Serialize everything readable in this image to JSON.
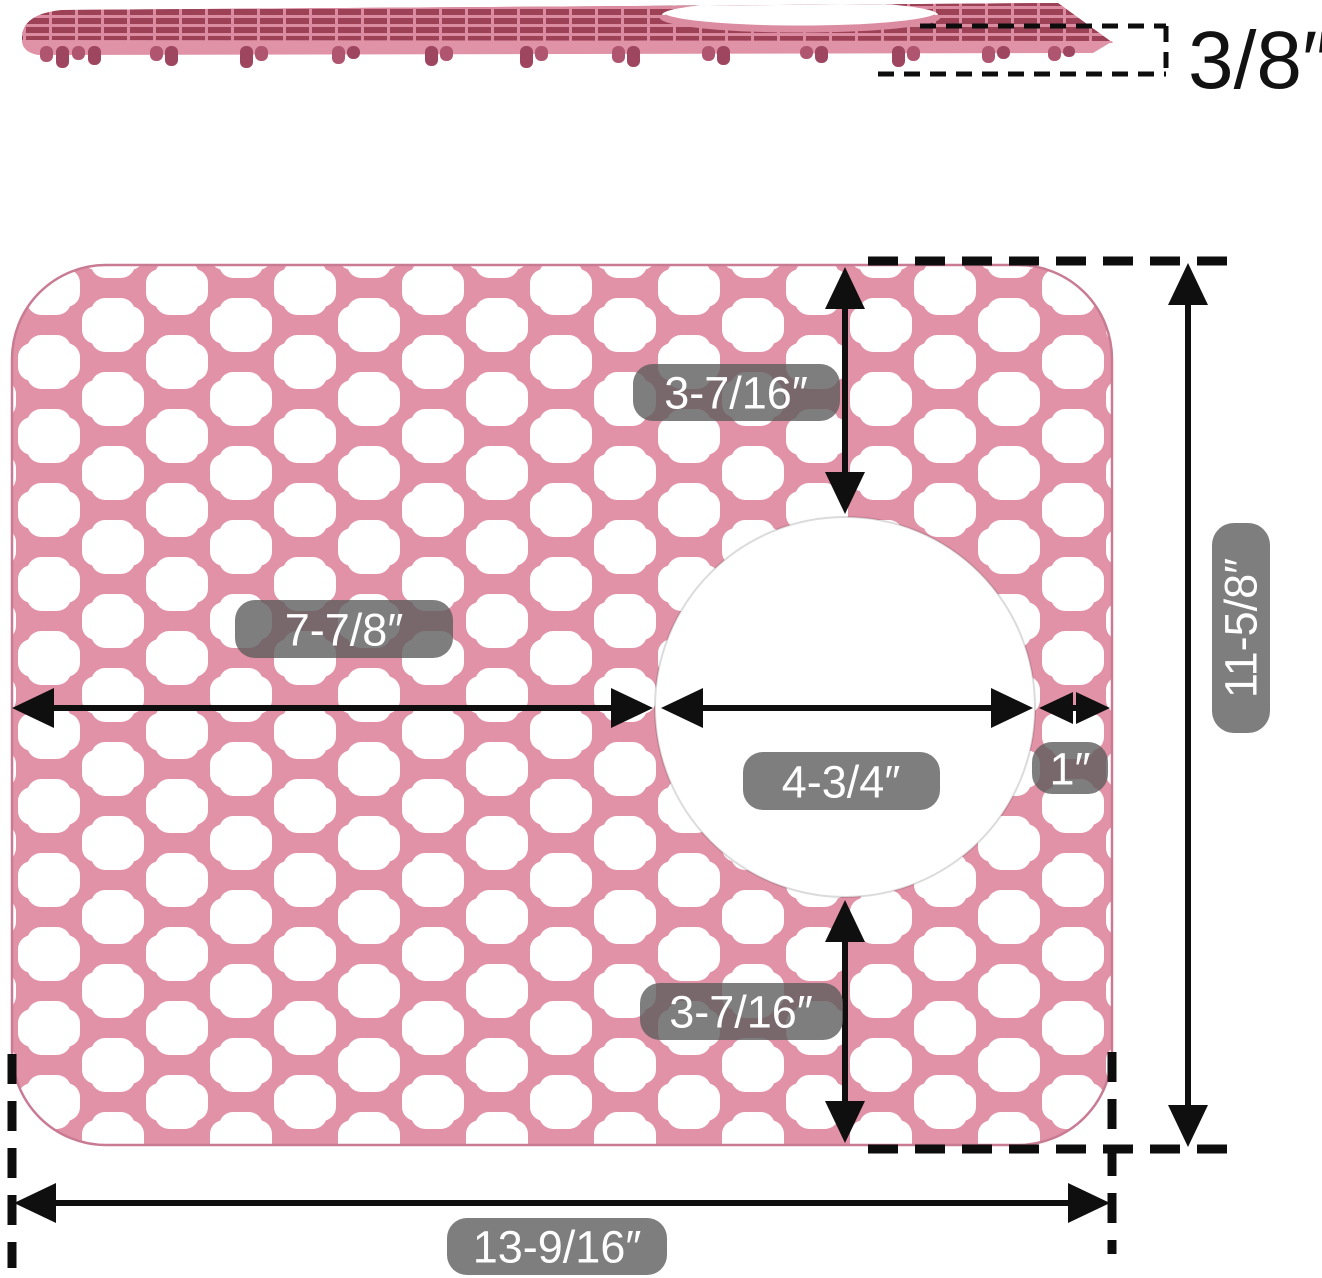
{
  "product": "sink-mat-dimension-diagram",
  "side_view": {
    "thickness": "3/8″"
  },
  "front_view": {
    "top_edge_to_hole": "3-7/16″",
    "left_edge_to_hole": "7-7/8″",
    "hole_diameter": "4-3/4″",
    "hole_to_right_edge": "1″",
    "overall_height": "11-5/8″",
    "hole_to_bottom_edge": "3-7/16″",
    "overall_width": "13-9/16″"
  },
  "colors": {
    "mat_pink": "#e192a7",
    "mat_edge": "#c87b93",
    "mesh_slot_dark": "#9c4156",
    "side_grid_pink": "#db8ca1",
    "feet_maroon": "#b05570",
    "feet_maroon_dark": "#9e4560",
    "hole_white": "#ffffff",
    "label_pill_bg": "#5e5e5e",
    "label_text": "#ffffff",
    "dimension_black": "#0f0f0f"
  }
}
